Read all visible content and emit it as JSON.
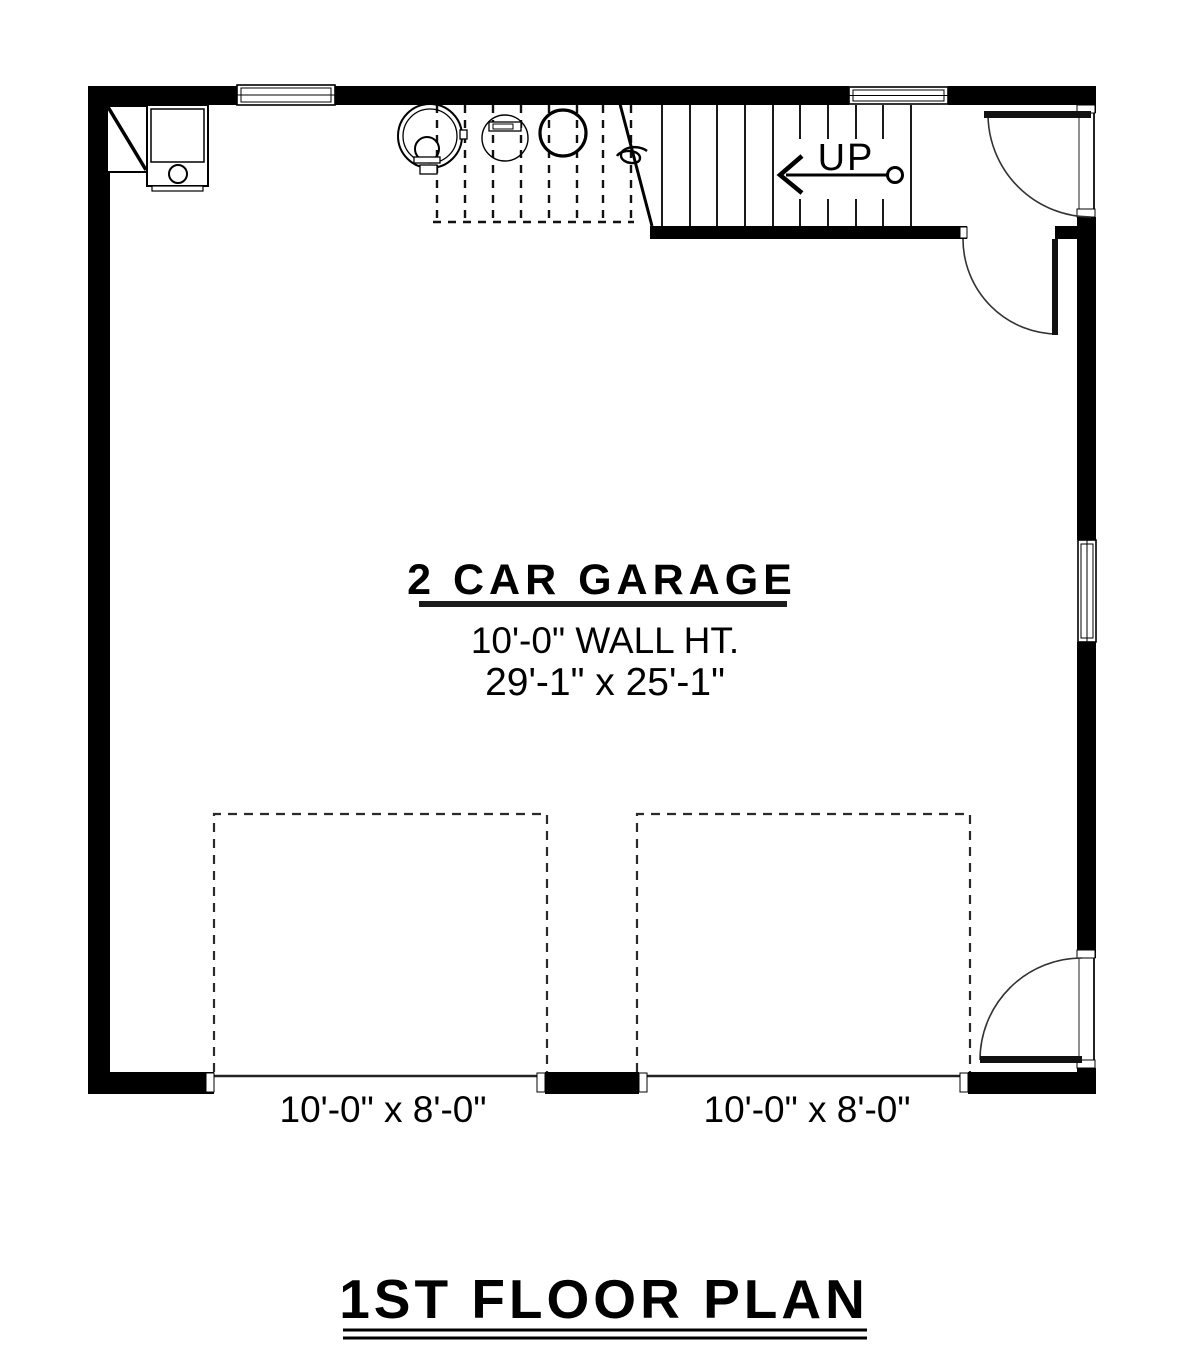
{
  "plan": {
    "sheet_title": "1ST FLOOR PLAN",
    "room_label": "2 CAR GARAGE",
    "wall_height_label": "10'-0\" WALL HT.",
    "room_dimensions_label": "29'-1\" x 25'-1\"",
    "stairs_up_label": "UP",
    "garage_door_labels": [
      "10'-0\" x 8'-0\"",
      "10'-0\" x 8'-0\""
    ]
  },
  "colors": {
    "walls": "#000000",
    "lines": "#111111",
    "dashed": "#2a2a2a",
    "background": "#ffffff"
  }
}
